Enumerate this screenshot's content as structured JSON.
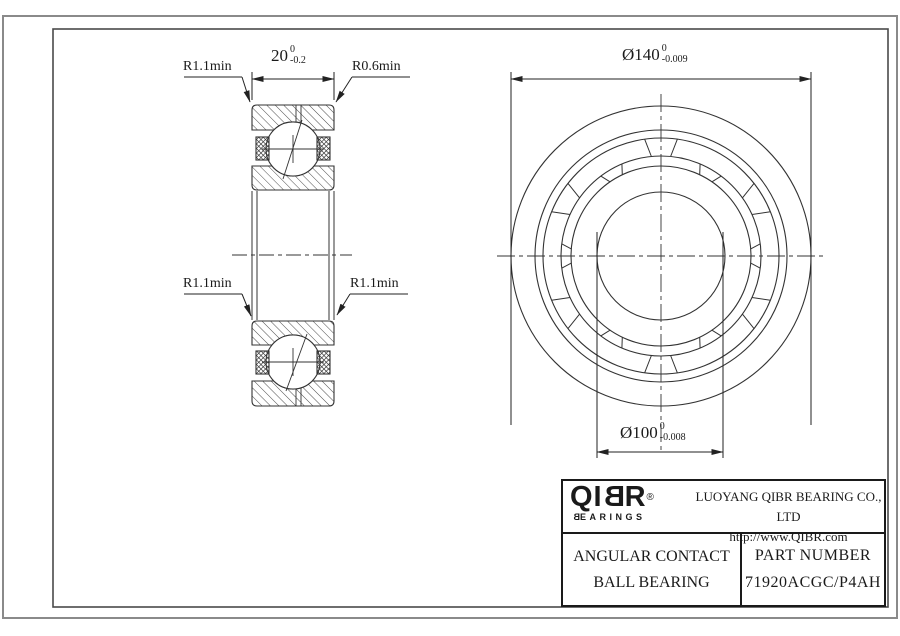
{
  "drawing": {
    "section_view": {
      "labels": {
        "fillet_top_left": "R1.1min",
        "fillet_top_right": "R0.6min",
        "fillet_mid_left": "R1.1min",
        "fillet_mid_right": "R1.1min"
      },
      "width_dim": {
        "value": "20",
        "tol_upper": "0",
        "tol_lower": "-0.2"
      }
    },
    "front_view": {
      "outer_dia_dim": {
        "value": "Ø140",
        "tol_upper": "0",
        "tol_lower": "-0.009"
      },
      "bore_dia_dim": {
        "value": "Ø100",
        "tol_upper": "0",
        "tol_lower": "-0.008"
      }
    }
  },
  "title_block": {
    "logo": {
      "part1": "QI",
      "part2": "B",
      "part3": "R",
      "registered": "®",
      "sub_first": "B",
      "sub_rest": "EARINGS"
    },
    "company": "LUOYANG QIBR BEARING CO., LTD",
    "website": "http://www.QIBR.com",
    "product": {
      "line1": "ANGULAR CONTACT",
      "line2": "BALL BEARING"
    },
    "part": {
      "label": "PART NUMBER",
      "number": "71920ACGC/P4AH"
    }
  }
}
